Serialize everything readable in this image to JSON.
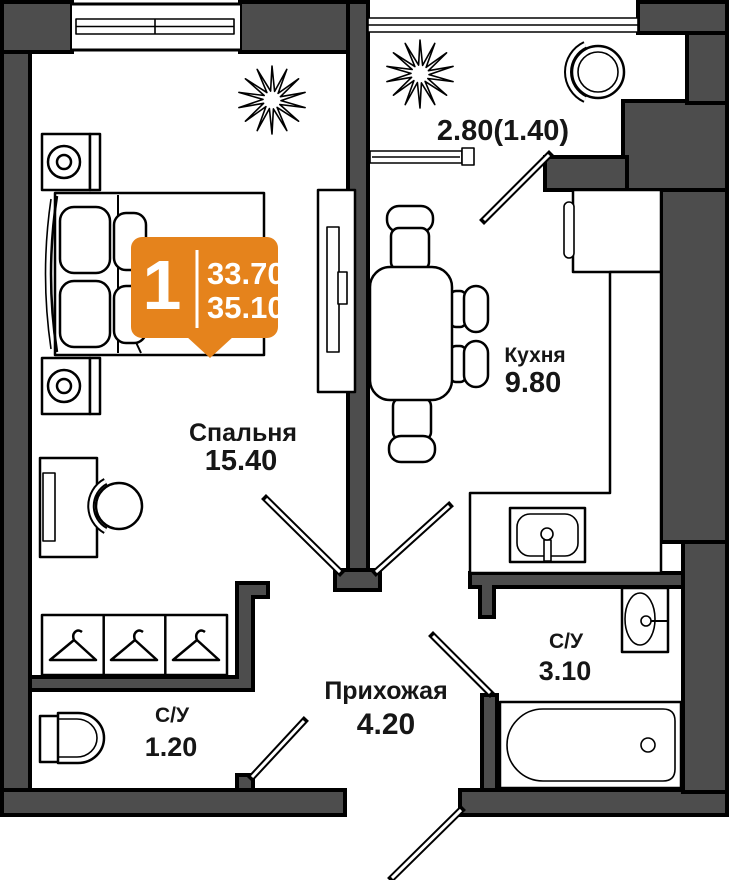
{
  "badge": {
    "rooms_count": "1",
    "area_1": "33.70",
    "area_2": "35.10"
  },
  "rooms": {
    "bedroom": {
      "name": "Спальня",
      "area": "15.40"
    },
    "kitchen": {
      "name": "Кухня",
      "area": "9.80"
    },
    "hallway": {
      "name": "Прихожая",
      "area": "4.20"
    },
    "bathroom": {
      "name": "С/У",
      "area": "3.10"
    },
    "wc": {
      "name": "С/У",
      "area": "1.20"
    },
    "balcony": {
      "area": "2.80(1.40)"
    }
  },
  "colors": {
    "wall": "#4D4D4D",
    "badge": "#E5831C",
    "outline": "#000000",
    "floor": "#FFFFFF"
  }
}
